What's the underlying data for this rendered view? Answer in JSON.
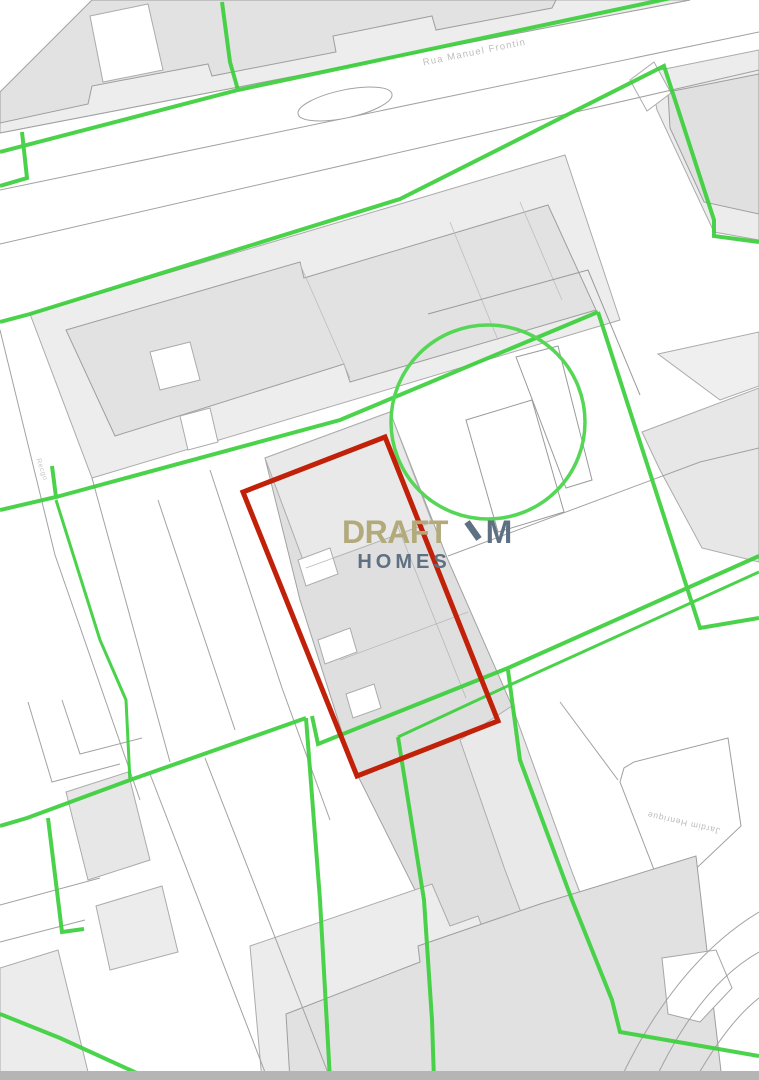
{
  "window": {
    "width": 759,
    "height": 1080
  },
  "map": {
    "type": "cadastral-plan",
    "watermark": {
      "brand": "DRAFT",
      "mark": "M",
      "sub": "HOMES",
      "brand_color": "#b3aa7c",
      "mark_color": "#5e7082"
    },
    "labels": {
      "street_top": "Rua Manuel Frontin",
      "street_left": "Recgo",
      "parcel_right": "Jardim Henrique"
    },
    "colors": {
      "boundary_green": "#3ccf3c",
      "circle_green": "#55d655",
      "plot_red": "#c22109",
      "parcel_fill": "#ededed",
      "building_fill": "#e2e2e2",
      "outline_gray": "#a5a5a5",
      "road_white": "#ffffff",
      "bottom_bar_gray": "#b5b5b5"
    }
  }
}
